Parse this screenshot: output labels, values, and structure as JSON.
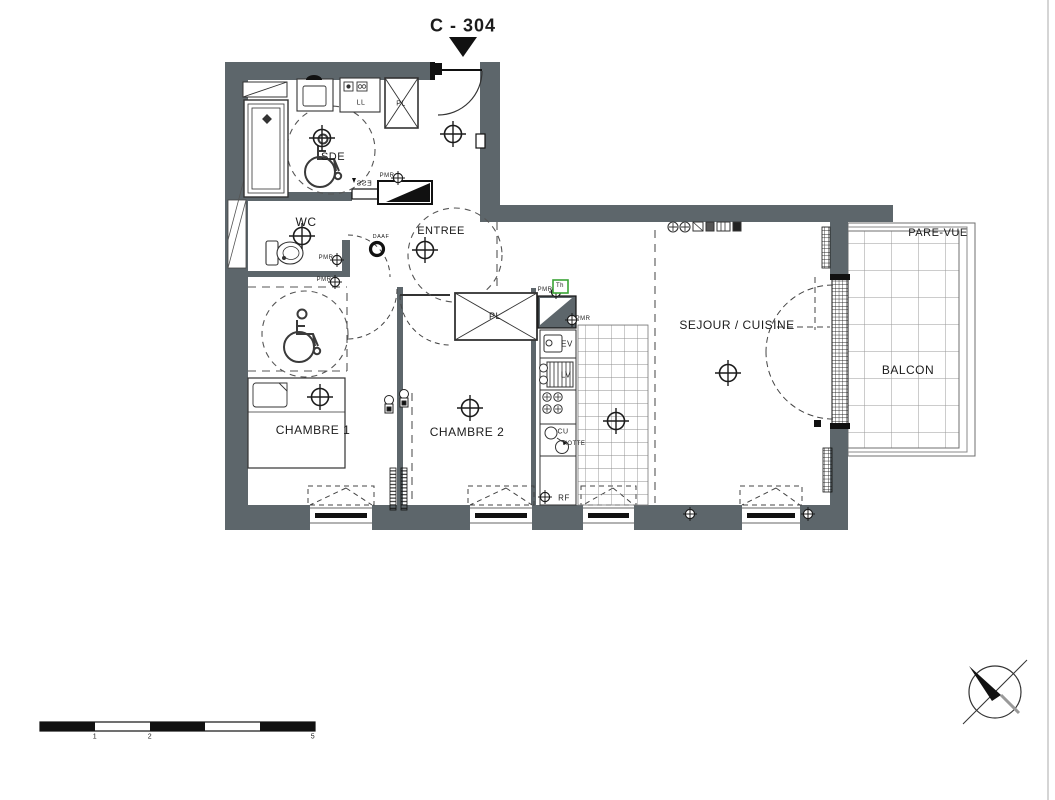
{
  "title": "C - 304",
  "rooms": {
    "sde": "SDE",
    "wc": "WC",
    "entree": "ENTREE",
    "chambre1": "CHAMBRE 1",
    "chambre2": "CHAMBRE 2",
    "sejour": "SEJOUR / CUISINE",
    "balcon": "BALCON",
    "pare_vue": "PARE-VUE"
  },
  "closets": {
    "pl1": "PL",
    "pl2": "PL"
  },
  "appliances": {
    "ll": "LL",
    "ev": "EV",
    "lv": "LV",
    "cu": "CU",
    "hotte": "HOTTE",
    "rf": "RF"
  },
  "annotations": {
    "daaf": "DAAF",
    "pmr": "PMR",
    "th": "Th",
    "ess": "ESS"
  },
  "scale_bar": {
    "labels": [
      "1",
      "2",
      "5"
    ]
  },
  "colors": {
    "wall": "#5d666b",
    "line": "#1c1c1c",
    "thermostat_green": "#3aa335"
  }
}
